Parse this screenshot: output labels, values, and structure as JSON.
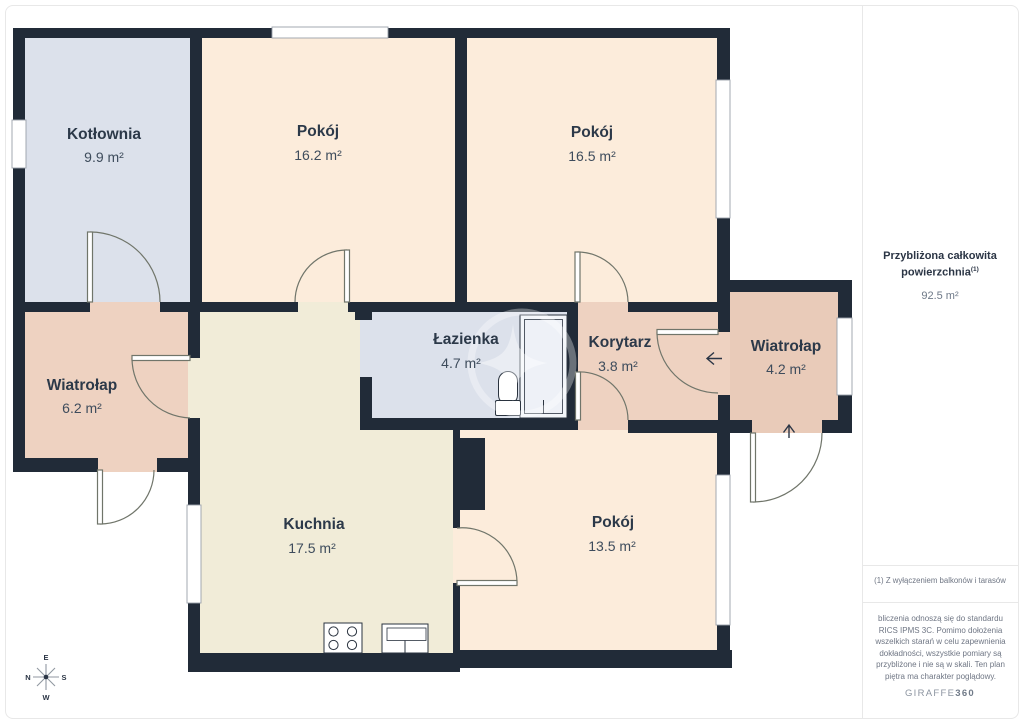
{
  "colors": {
    "wall": "#212b38",
    "door": "#70756a",
    "fixture": "#2a333f",
    "window_frame": "#9aa0aa",
    "room_peach": "#fcecdb",
    "room_beige": "#f1ecd8",
    "room_blue": "#dce1eb",
    "room_salmon": "#eed2c1",
    "room_salmon_dark": "#e9cbb9",
    "label_dark": "#2c3949",
    "label_area": "#3e4c5c",
    "arrow": "#2b3545",
    "compass_line": "#9097a1",
    "border": "#e8e8e8"
  },
  "rooms": [
    {
      "name": "Kotłownia",
      "area": "9.9 m²"
    },
    {
      "name": "Pokój",
      "area": "16.2 m²"
    },
    {
      "name": "Pokój",
      "area": "16.5 m²"
    },
    {
      "name": "Wiatrołap",
      "area": "6.2 m²"
    },
    {
      "name": "Łazienka",
      "area": "4.7 m²"
    },
    {
      "name": "Korytarz",
      "area": "3.8 m²"
    },
    {
      "name": "Wiatrołap",
      "area": "4.2 m²"
    },
    {
      "name": "Kuchnia",
      "area": "17.5 m²"
    },
    {
      "name": "Pokój",
      "area": "13.5 m²"
    }
  ],
  "sidebar": {
    "title_line1": "Przybliżona całkowita",
    "title_line2": "powierzchnia",
    "title_sup": "(1)",
    "total_area": "92.5 m²",
    "note": "(1) Z wyłączeniem balkonów i tarasów",
    "disclaimer": "bliczenia odnoszą się do standardu RICS IPMS 3C. Pomimo dołożenia wszelkich starań w celu zapewnienia dokładności, wszystkie pomiary są przybliżone i nie są w skali. Ten plan piętra ma charakter poglądowy.",
    "logo_main": "GIRAFFE",
    "logo_suffix": "360"
  },
  "compass": {
    "top": "E",
    "left": "N",
    "right": "S",
    "bottom": "W"
  }
}
